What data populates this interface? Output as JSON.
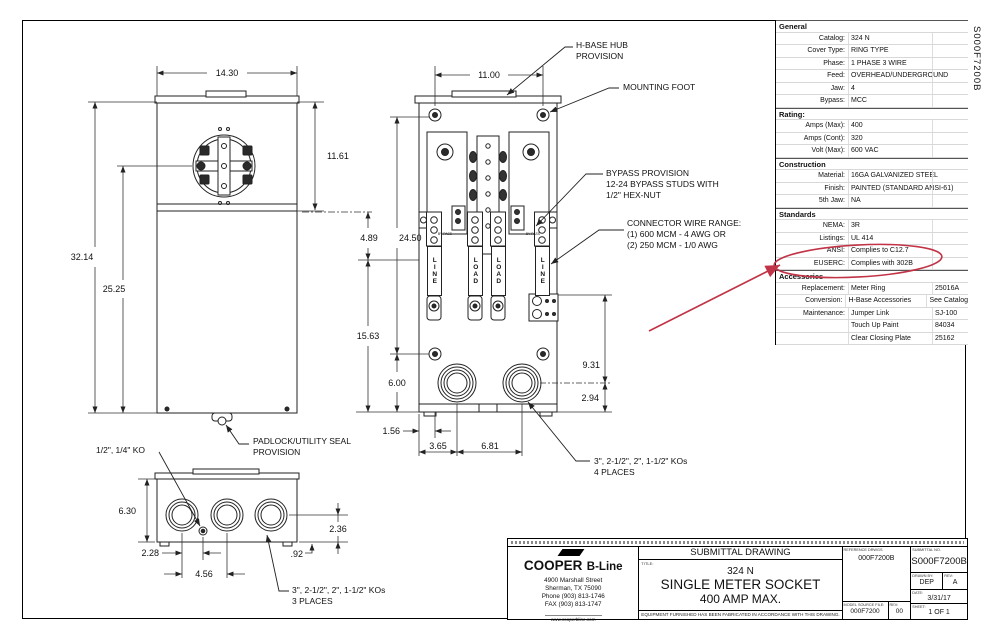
{
  "sheet": {
    "code_vertical": "S000F7200B"
  },
  "spec_table": {
    "rows": [
      {
        "t": "h",
        "label": "General"
      },
      {
        "t": "r",
        "label": "Catalog:",
        "value": "324 N"
      },
      {
        "t": "r",
        "label": "Cover Type:",
        "value": "RING TYPE"
      },
      {
        "t": "r",
        "label": "Phase:",
        "value": "1 PHASE 3 WIRE"
      },
      {
        "t": "r",
        "label": "Feed:",
        "value": "OVERHEAD/UNDERGROUND"
      },
      {
        "t": "r",
        "label": "Jaw:",
        "value": "4"
      },
      {
        "t": "r",
        "label": "Bypass:",
        "value": "MCC"
      },
      {
        "t": "h",
        "label": "Rating:"
      },
      {
        "t": "r",
        "label": "Amps (Max):",
        "value": "400"
      },
      {
        "t": "r",
        "label": "Amps (Cont):",
        "value": "320"
      },
      {
        "t": "r",
        "label": "Volt (Max):",
        "value": "600 VAC"
      },
      {
        "t": "h",
        "label": "Construction"
      },
      {
        "t": "r",
        "label": "Material:",
        "value": "16GA GALVANIZED STEEL"
      },
      {
        "t": "r",
        "label": "Finish:",
        "value": "PAINTED (STANDARD ANSI-61)"
      },
      {
        "t": "r",
        "label": "5th Jaw:",
        "value": "NA"
      },
      {
        "t": "h",
        "label": "Standards"
      },
      {
        "t": "r",
        "label": "NEMA:",
        "value": "3R"
      },
      {
        "t": "r",
        "label": "Listings:",
        "value": "UL 414"
      },
      {
        "t": "r",
        "label": "ANSI:",
        "value": "Complies to C12.7"
      },
      {
        "t": "r",
        "label": "EUSERC:",
        "value": "Complies with 302B"
      },
      {
        "t": "h",
        "label": "Accessories"
      },
      {
        "t": "r",
        "label": "Replacement:",
        "value": "Meter Ring",
        "extra": "25016A"
      },
      {
        "t": "r",
        "label": "Conversion:",
        "value": "H-Base Accessories",
        "extra": "See Catalog"
      },
      {
        "t": "r",
        "label": "Maintenance:",
        "value": "Jumper Link",
        "extra": "SJ-100"
      },
      {
        "t": "r",
        "label": "",
        "value": "Touch Up Paint",
        "extra": "84034"
      },
      {
        "t": "r",
        "label": "",
        "value": "Clear Closing Plate",
        "extra": "25162"
      }
    ]
  },
  "drawing": {
    "callouts": {
      "h_base": [
        "H-BASE HUB",
        "PROVISION"
      ],
      "mounting_foot": "MOUNTING FOOT",
      "bypass": [
        "BYPASS PROVISION",
        "12-24 BYPASS STUDS WITH",
        "1/2\" HEX-NUT"
      ],
      "connector": [
        "CONNECTOR WIRE RANGE:",
        "(1) 600 MCM - 4 AWG OR",
        "(2) 250 MCM - 1/0 AWG"
      ],
      "padlock": [
        "PADLOCK/UTILITY SEAL",
        "PROVISION"
      ],
      "small_ko": "1/2\", 1/4\" KO",
      "ko_4_places": [
        "3\", 2-1/2\", 2\", 1-1/2\" KOs",
        "4 PLACES"
      ],
      "ko_3_places": [
        "3\", 2-1/2\", 2\", 1-1/2\" KOs",
        "3 PLACES"
      ]
    },
    "dims": {
      "front_width": "14.30",
      "front_upper": "11.61",
      "front_height": "32.14",
      "front_meter": "25.25",
      "inner_width": "11.00",
      "seg_489": "4.89",
      "overall_2450": "24.50",
      "seg_1563": "15.63",
      "seg_600": "6.00",
      "right_931": "9.31",
      "right_294": "2.94",
      "bot_156": "1.56",
      "bot_365": "3.65",
      "bot_681": "6.81",
      "bv_height": "6.30",
      "bv_228": "2.28",
      "bv_456": "4.56",
      "bv_236": "2.36",
      "bv_92": ".92"
    },
    "bus_labels": [
      "LINE",
      "LOAD",
      "LOAD",
      "LINE"
    ],
    "bypass_stud_label": "BY-PASS"
  },
  "annotation": {
    "highlight_color": "#c13346",
    "circled_text": "Complies with 302B"
  },
  "title_block": {
    "drawing_type": "SUBMITTAL DRAWING",
    "title_label": "TITLE:",
    "title_lines": [
      "324 N",
      "SINGLE METER SOCKET",
      "400 AMP MAX."
    ],
    "equipment_note": "EQUIPMENT FURNISHED HAS BEEN FABRICATED IN ACCORDANCE WITH THIS DRAWING.",
    "company": {
      "name_primary": "COOPER",
      "name_secondary": "B-Line",
      "address_lines": [
        "4900 Marshall Street",
        "Sherman, TX  75090",
        "Phone (903) 813-1746",
        "FAX (903) 813-1747"
      ],
      "website": "www.cooperbline.com"
    },
    "reference_drwgs": {
      "label": "REFERENCE DRWGS",
      "value": "000F7200B"
    },
    "submittal_no": {
      "label": "SUBMITTAL NO.",
      "value": "S000F7200B"
    },
    "drawn_by": {
      "label": "DRAWN BY:",
      "value": "DEP"
    },
    "rev": {
      "label": "REV:",
      "value": "A"
    },
    "date": {
      "label": "DATE:",
      "value": "3/31/17"
    },
    "model_source_file": {
      "label": "MODEL SOURCE FILE:",
      "value": "000F7200"
    },
    "model_rev": {
      "label": "REV:",
      "value": "00"
    },
    "sheet_field": {
      "label": "SHEET:",
      "value": "1 OF 1"
    }
  }
}
